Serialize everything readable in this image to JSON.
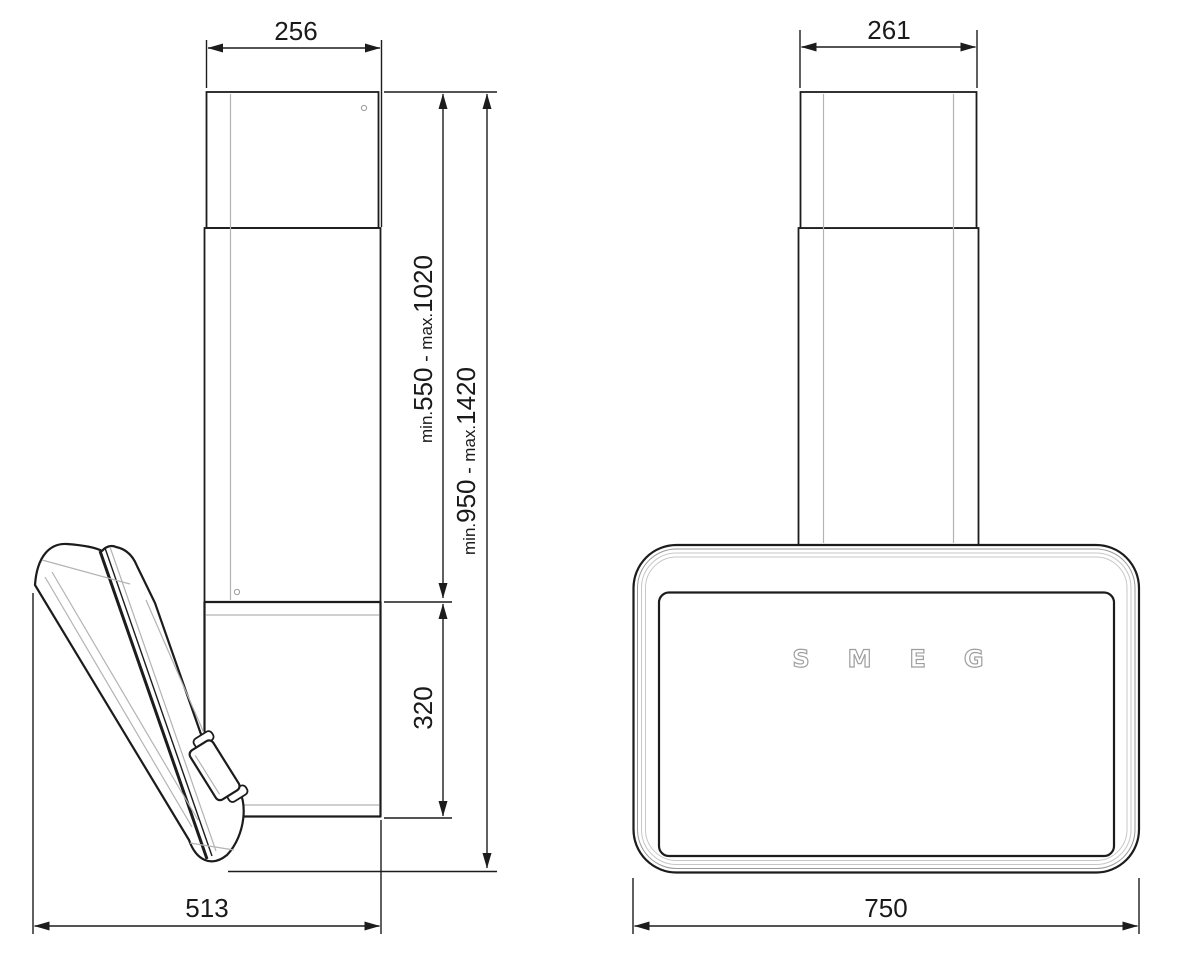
{
  "drawing": {
    "colors": {
      "line_dark": "#1c1c1c",
      "line_gray": "#b3b3b3",
      "logo_gray": "#9e9e9e",
      "background": "#ffffff"
    },
    "side_view": {
      "dim_chimney_width": "256",
      "dim_body_height": "320",
      "dim_depth": "513",
      "dim_chimney_height": {
        "min_label": "min.",
        "min_value": "550",
        "separator": " - ",
        "max_label": "max.",
        "max_value": "1020"
      },
      "dim_total_height": {
        "min_label": "min.",
        "min_value": "950",
        "separator": " - ",
        "max_label": "max.",
        "max_value": "1420"
      }
    },
    "front_view": {
      "dim_chimney_width": "261",
      "dim_width": "750",
      "logo": "SMEG"
    }
  }
}
